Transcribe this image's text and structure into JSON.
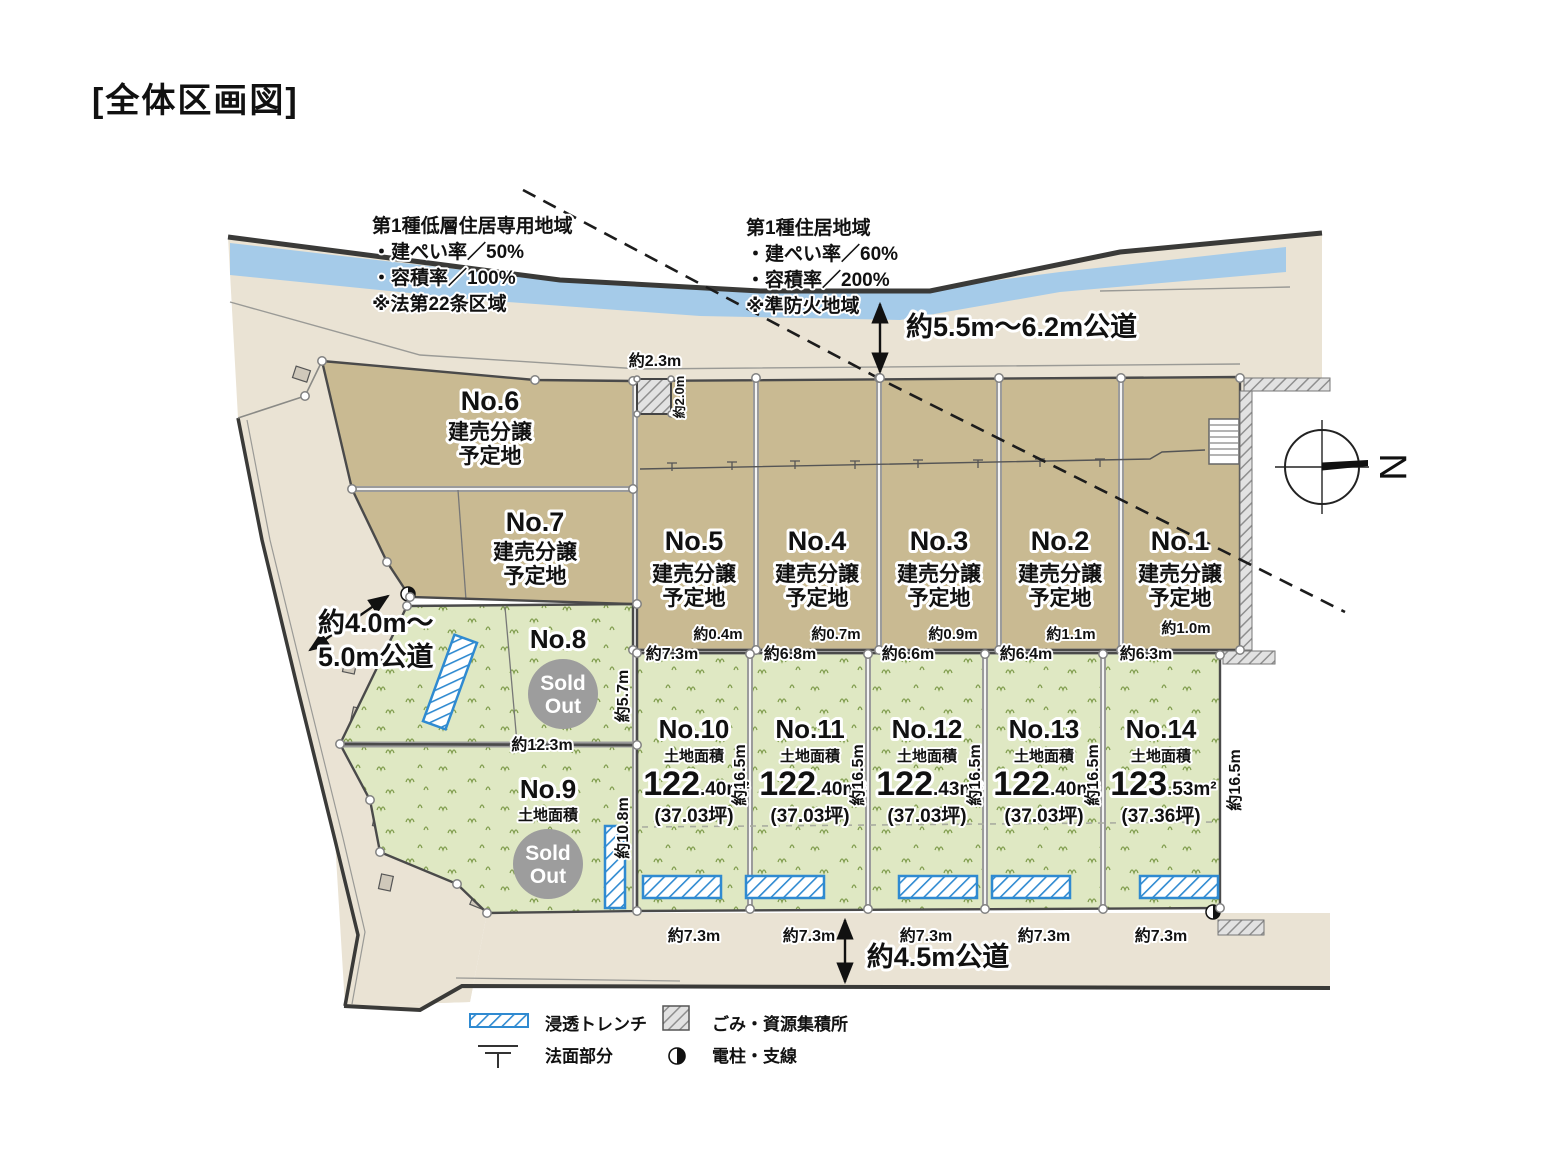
{
  "title": "[全体区画図]",
  "zoning_left": {
    "name": "第1種低層住居専用地域",
    "coverage": "・建ぺい率／50%",
    "far": "・容積率／100%",
    "note": "※法第22条区域"
  },
  "zoning_right": {
    "name": "第1種住居地域",
    "coverage": "・建ぺい率／60%",
    "far": "・容積率／200%",
    "note": "※準防火地域"
  },
  "roads": {
    "top": "約5.5m〜6.2m公道",
    "left_line1": "約4.0m〜",
    "left_line2": "5.0m公道",
    "bottom": "約4.5m公道"
  },
  "compass": {
    "label": "N"
  },
  "lots": {
    "no6": {
      "no": "No.6",
      "type1": "建売分譲",
      "type2": "予定地"
    },
    "no7": {
      "no": "No.7",
      "type1": "建売分譲",
      "type2": "予定地"
    },
    "no5": {
      "no": "No.5",
      "type1": "建売分譲",
      "type2": "予定地"
    },
    "no4": {
      "no": "No.4",
      "type1": "建売分譲",
      "type2": "予定地"
    },
    "no3": {
      "no": "No.3",
      "type1": "建売分譲",
      "type2": "予定地"
    },
    "no2": {
      "no": "No.2",
      "type1": "建売分譲",
      "type2": "予定地"
    },
    "no1": {
      "no": "No.1",
      "type1": "建売分譲",
      "type2": "予定地"
    },
    "no8": {
      "no": "No.8",
      "sold1": "Sold",
      "sold2": "Out"
    },
    "no9": {
      "no": "No.9",
      "area_label": "土地面積",
      "sold1": "Sold",
      "sold2": "Out"
    },
    "no10": {
      "no": "No.10",
      "area_label": "土地面積",
      "area_main": "122",
      "area_sub": ".40m²",
      "tsubo": "(37.03坪)"
    },
    "no11": {
      "no": "No.11",
      "area_label": "土地面積",
      "area_main": "122",
      "area_sub": ".40m²",
      "tsubo": "(37.03坪)"
    },
    "no12": {
      "no": "No.12",
      "area_label": "土地面積",
      "area_main": "122",
      "area_sub": ".43m²",
      "tsubo": "(37.03坪)"
    },
    "no13": {
      "no": "No.13",
      "area_label": "土地面積",
      "area_main": "122",
      "area_sub": ".40m²",
      "tsubo": "(37.03坪)"
    },
    "no14": {
      "no": "No.14",
      "area_label": "土地面積",
      "area_main": "123",
      "area_sub": ".53m²",
      "tsubo": "(37.36坪)"
    }
  },
  "dims": {
    "top_setback": "約2.3m",
    "garbage_size": "約2.0m",
    "no8_width": "約12.3m",
    "offset_1": "約0.4m",
    "offset_2": "約0.7m",
    "offset_3": "約0.9m",
    "offset_4": "約1.1m",
    "offset_5": "約1.0m",
    "brown_w1": "約7.3m",
    "brown_w2": "約6.8m",
    "brown_w3": "約6.6m",
    "brown_w4": "約6.4m",
    "brown_w5": "約6.3m",
    "green_w1": "約7.3m",
    "green_w2": "約7.3m",
    "green_w3": "約7.3m",
    "green_w4": "約7.3m",
    "green_w5": "約7.3m",
    "depth_no8": "約5.7m",
    "depth_no9": "約10.8m",
    "depth_1": "約16.5m",
    "depth_2": "約16.5m",
    "depth_3": "約16.5m",
    "depth_4": "約16.5m",
    "depth_5": "約16.5m"
  },
  "legend": {
    "trench": "浸透トレンチ",
    "garbage": "ごみ・資源集積所",
    "slope": "法面部分",
    "pole": "電柱・支線"
  },
  "colors": {
    "lot_brown": "#c9ba92",
    "lot_green": "#dfe8c3",
    "river": "#a5cbe9",
    "terrain": "#eae3d4",
    "sold_gray": "#9d9d9d",
    "trench_blue": "#2f8ad1"
  }
}
